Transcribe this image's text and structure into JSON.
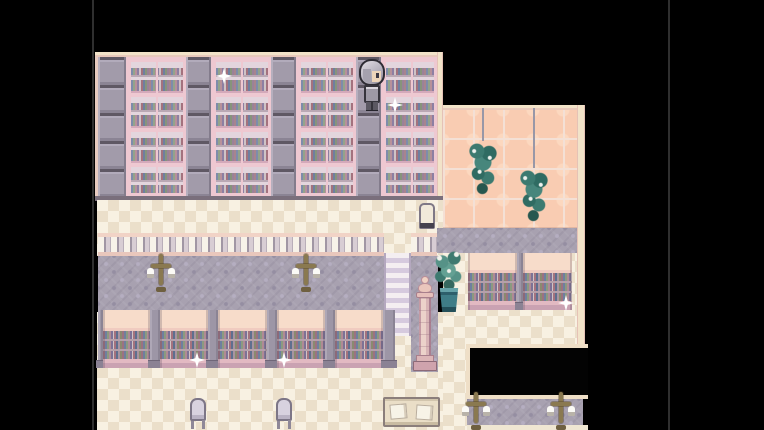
{
  "scene": {
    "description": "Top-down pixel-art library interior (RPG-style). A main hall with four tall pink bookshelves separated by gray pillars, a checkered cream walkway, a balustrade with a staircase gap, a gray damask reading carpet with two cross candelabra, a row of five low bookcases, and a checkered lower floor with two chairs and a reading table. A pink-tiled annex on the right has two hanging plants, a potted plant, two low bookcases, a pedestal statue, a standing sign, a black stairwell pit and a lower passage with two more cross candelabra. A gray-haired character stands in a shelf aisle. Five white sparkles glint on shelves.",
    "palette": {
      "background": "#000000",
      "floor_checker_light": "#f8f1e2",
      "floor_checker_dark": "#ebdfca",
      "carpet_gray": "#a8a1b0",
      "annex_wall_peach": "#f9ccb2",
      "shelf_frame_pink": "#eec8d1",
      "pillar_gray": "#a29baa",
      "trim_cream": "#f2e3c9",
      "plant_teal": "#47867c",
      "candelabrum_gold": "#8a7950",
      "sparkle_white": "#ffffff",
      "pit_black": "#030303"
    },
    "counts": {
      "tall_bookshelves": 4,
      "tall_pillars": 4,
      "low_bookcases_hall": 5,
      "low_bookcases_annex": 2,
      "hanging_plants": 2,
      "cross_candelabra": 4,
      "chairs": 2,
      "sparkles": 5
    },
    "character": {
      "label": "gray-haired character",
      "facing": "down",
      "x": 263,
      "y": 56
    },
    "sparkles": [
      {
        "x": 121,
        "y": 68
      },
      {
        "x": 292,
        "y": 97
      },
      {
        "x": 94,
        "y": 352
      },
      {
        "x": 181,
        "y": 352
      },
      {
        "x": 463,
        "y": 295
      }
    ],
    "objects": {
      "hanging_plant_1": {
        "x": 371,
        "y": 141
      },
      "hanging_plant_2": {
        "x": 422,
        "y": 168
      },
      "sign": {
        "x": 324,
        "y": 203
      },
      "potted_plant": {
        "x": 337,
        "y": 248
      },
      "pedestal": {
        "x": 317,
        "y": 276
      },
      "cross_hall_1": {
        "x": 53,
        "y": 254
      },
      "cross_hall_2": {
        "x": 198,
        "y": 254
      },
      "cross_lower_1": {
        "x": 368,
        "y": 392
      },
      "cross_lower_2": {
        "x": 453,
        "y": 392
      },
      "chair_1": {
        "x": 95,
        "y": 398
      },
      "chair_2": {
        "x": 181,
        "y": 398
      },
      "reading_table": {
        "x": 288,
        "y": 397
      }
    }
  }
}
